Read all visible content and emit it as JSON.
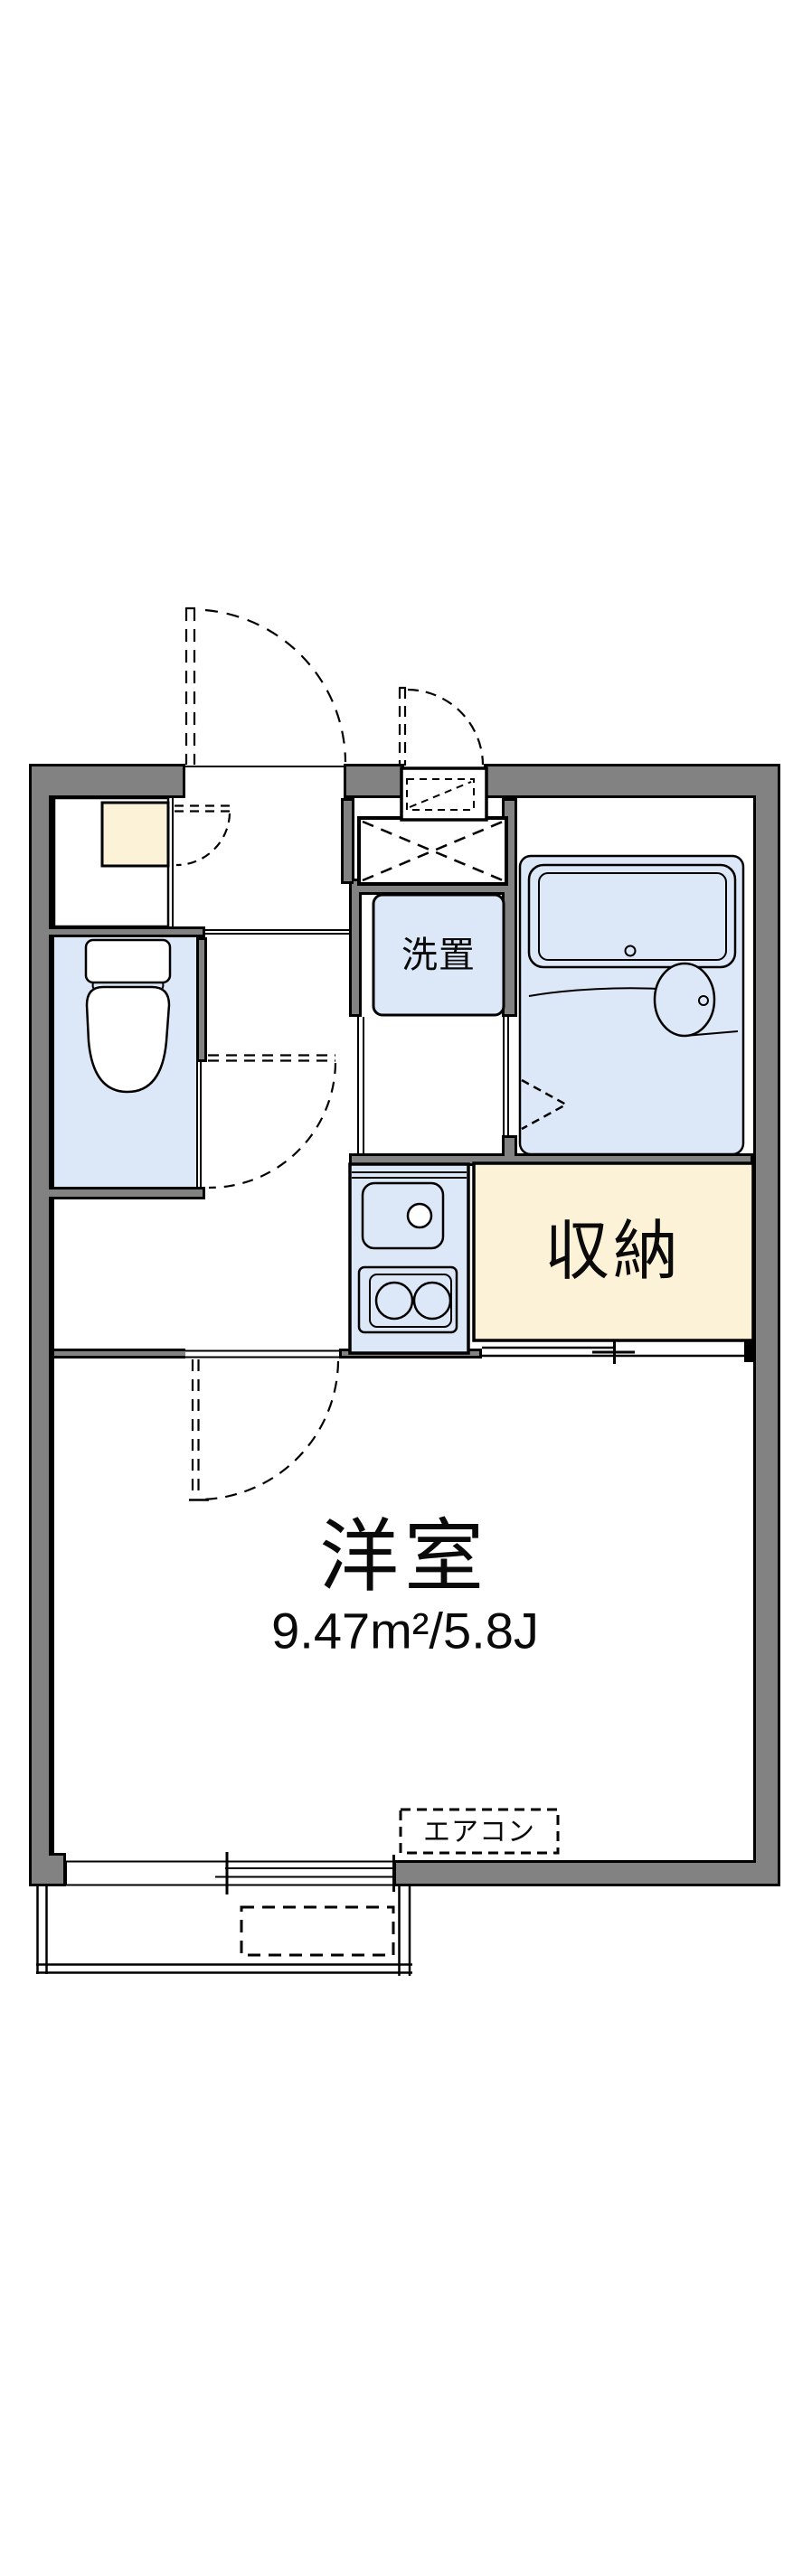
{
  "document": {
    "type": "floor-plan"
  },
  "colors": {
    "wall": "#828282",
    "water": "#dce8f8",
    "cream": "#fcf2d8",
    "line": "#000000",
    "background": "#ffffff"
  },
  "labels": {
    "main_room": "洋室",
    "main_room_area": "9.47m²/5.8J",
    "storage": "収納",
    "laundry": "洗置",
    "air_conditioner": "エアコン"
  }
}
